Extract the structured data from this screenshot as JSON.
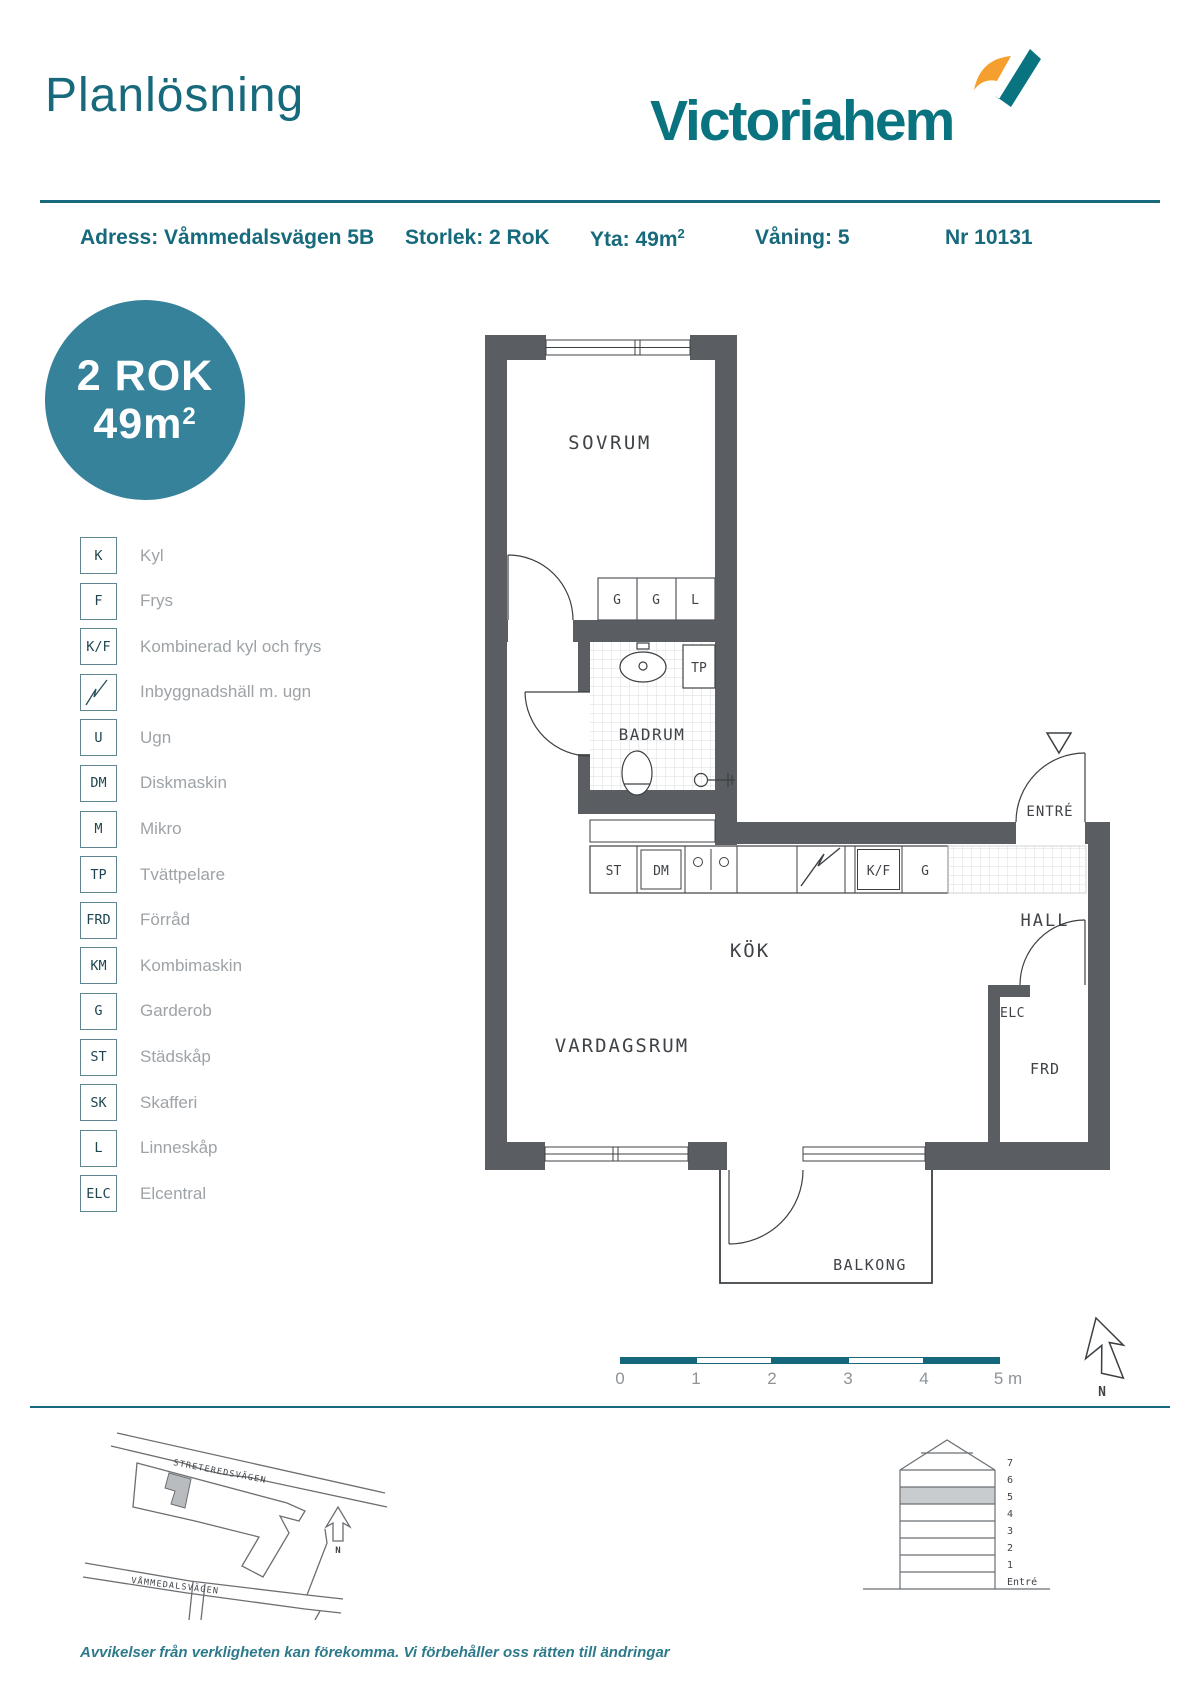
{
  "header": {
    "title": "Planlösning",
    "brand": "Victoriahem"
  },
  "info": {
    "address": "Adress: Våmmedalsvägen 5B",
    "size": "Storlek: 2 RoK",
    "area_text": "Yta: 49m",
    "area_sup": "2",
    "floor": "Våning: 5",
    "number": "Nr 10131"
  },
  "badge": {
    "line1": "2 ROK",
    "line2": "49m",
    "sup": "2"
  },
  "legend": {
    "items": [
      {
        "key": "K",
        "label": "Kyl"
      },
      {
        "key": "F",
        "label": "Frys"
      },
      {
        "key": "K/F",
        "label": "Kombinerad kyl och frys"
      },
      {
        "key": "",
        "label": "Inbyggnadshäll m. ugn"
      },
      {
        "key": "U",
        "label": "Ugn"
      },
      {
        "key": "DM",
        "label": "Diskmaskin"
      },
      {
        "key": "M",
        "label": "Mikro"
      },
      {
        "key": "TP",
        "label": "Tvättpelare"
      },
      {
        "key": "FRD",
        "label": "Förråd"
      },
      {
        "key": "KM",
        "label": "Kombimaskin"
      },
      {
        "key": "G",
        "label": "Garderob"
      },
      {
        "key": "ST",
        "label": "Städskåp"
      },
      {
        "key": "SK",
        "label": "Skafferi"
      },
      {
        "key": "L",
        "label": "Linneskåp"
      },
      {
        "key": "ELC",
        "label": "Elcentral"
      }
    ]
  },
  "plan": {
    "rooms": {
      "sovrum": "SOVRUM",
      "badrum": "BADRUM",
      "kok": "KÖK",
      "vardagsrum": "VARDAGSRUM",
      "hall": "HALL",
      "entre": "ENTRÉ",
      "frd": "FRD",
      "elc": "ELC",
      "balkong": "BALKONG"
    },
    "fixtures": {
      "wardrobe1": "G",
      "wardrobe2": "G",
      "linen": "L",
      "tp": "TP",
      "st": "ST",
      "dm": "DM",
      "kf": "K/F",
      "hall_wardrobe": "G"
    }
  },
  "scalebar": {
    "ticks": [
      "0",
      "1",
      "2",
      "3",
      "4",
      "5 m"
    ]
  },
  "compass": {
    "north": "N"
  },
  "sitemap": {
    "street_top": "STRETEREDSVÄGEN",
    "street_bottom": "VÅMMEDALSVÄGEN",
    "north": "N"
  },
  "elevation": {
    "floors": [
      "7",
      "6",
      "5",
      "4",
      "3",
      "2",
      "1",
      "Entré"
    ],
    "highlighted_floor": "5"
  },
  "footer": {
    "disclaimer": "Avvikelser från verkligheten kan förekomma. Vi förbehåller oss rätten till ändringar"
  },
  "colors": {
    "accent_teal": "#17697C",
    "logo_teal": "#0A7380",
    "logo_orange": "#F5A02E",
    "badge_teal": "#36829B",
    "wall_gray": "#5A5E62",
    "floor_highlight": "#C9CCCE"
  }
}
